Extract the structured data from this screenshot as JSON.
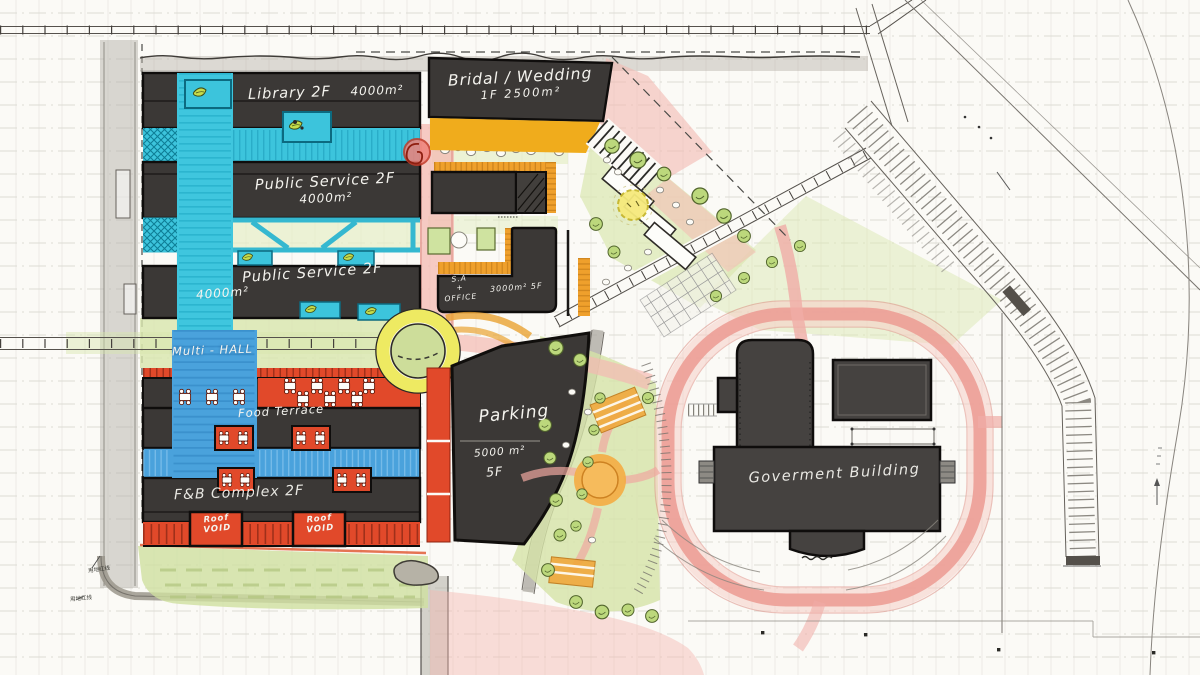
{
  "labels": {
    "library": {
      "name": "Library 2F",
      "area": "4000m²"
    },
    "bridal": {
      "name": "Bridal / Wedding",
      "detail": "1F  2500m²"
    },
    "public_service_upper": {
      "name": "Public Service 2F",
      "area": "4000m²"
    },
    "public_service_lower": {
      "name": "Public Service 2F",
      "area": "4000m²"
    },
    "multi_hall": {
      "name": "Multi - HALL"
    },
    "food_terrace": {
      "name": "Food Terrace"
    },
    "fb_complex": {
      "name": "F&B Complex  2F"
    },
    "roof_void_left": {
      "line1": "Roof",
      "line2": "VOID"
    },
    "roof_void_right": {
      "line1": "Roof",
      "line2": "VOID"
    },
    "sa_office": {
      "line1": "S.A",
      "line2": "+",
      "line3": "OFFICE",
      "detail": "3000m²  5F"
    },
    "parking": {
      "name": "Parking",
      "area": "5000 m²",
      "floors": "5F"
    },
    "government": {
      "name": "Goverment Building"
    },
    "boundary_note_upper": "用地红线",
    "boundary_note_lower": "用地红线"
  },
  "colors": {
    "building_dark": "#3b3836",
    "government_dark": "#454240",
    "canal_cyan": "#3cc4dc",
    "spine_blue": "#4aa2dc",
    "terrace_red": "#e1492a",
    "accent_yellow": "#f0ac1c",
    "roundabout_yellow": "#eeea62",
    "road_pink": "#f2b0aa",
    "lawn_green": "#d6e4a8",
    "paper": "#fbfaf6"
  }
}
